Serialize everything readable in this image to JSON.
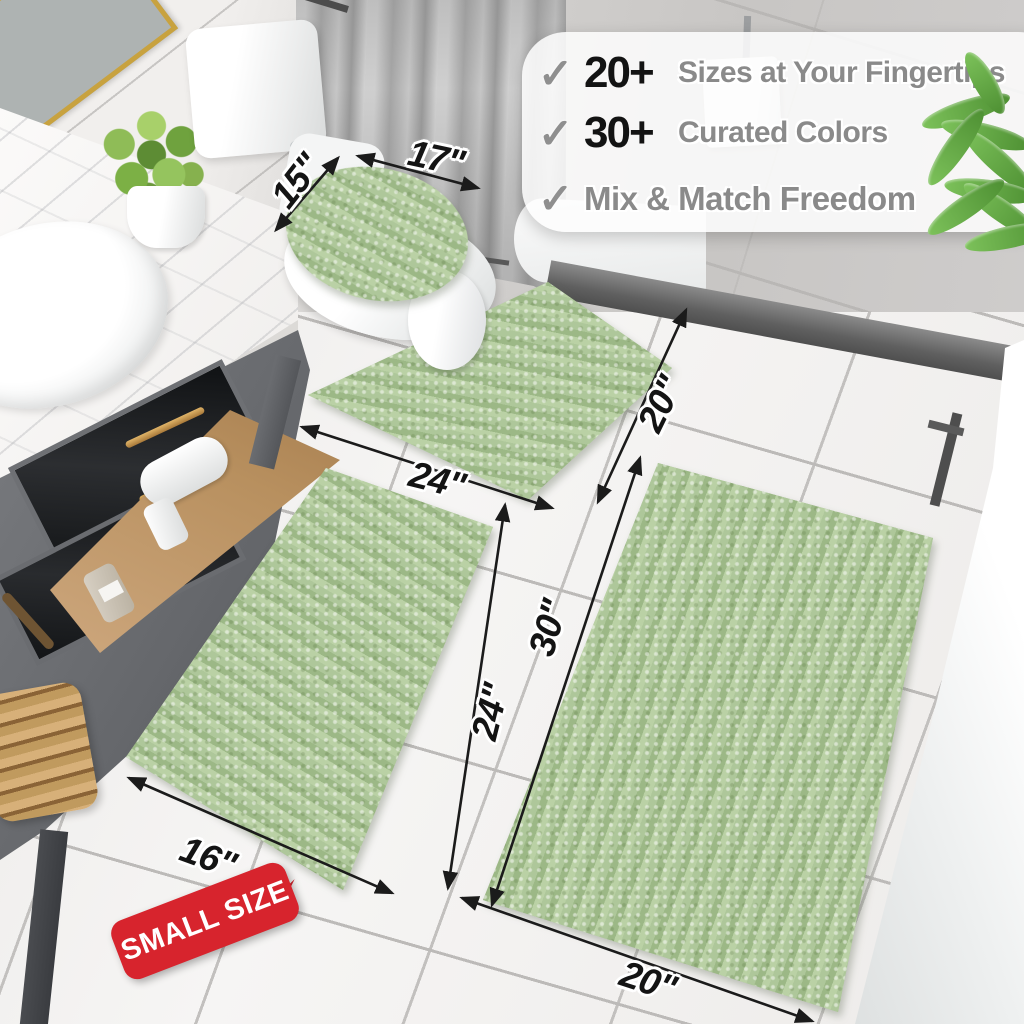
{
  "features": {
    "items": [
      {
        "check": "✓",
        "value": "20+",
        "label": "Sizes at Your Fingertips"
      },
      {
        "check": "✓",
        "value": "30+",
        "label": "Curated Colors"
      },
      {
        "check": "✓",
        "value": "",
        "label": "Mix & Match Freedom"
      }
    ]
  },
  "dimensions": {
    "lid_depth": "15\"",
    "lid_width": "17\"",
    "contour_width": "24\"",
    "contour_depth": "20\"",
    "small_rug_width": "16\"",
    "small_rug_length": "24\"",
    "large_rug_length": "30\"",
    "large_rug_width": "20\""
  },
  "badge": {
    "label": "SMALL SIZE"
  },
  "colors": {
    "rug_green": "#a9c296",
    "rug_stripe_dark": "#9cb886",
    "rug_stripe_light": "#bad1a5",
    "badge_red": "#d7242d",
    "dimension_ink": "#141414",
    "feature_number": "#131313",
    "feature_text": "#8a8a8a",
    "checkmark": "#8f8f8f",
    "floor": "#f3f2f1",
    "wall": "#cecccb",
    "vanity_gold": "#c79b4e"
  }
}
